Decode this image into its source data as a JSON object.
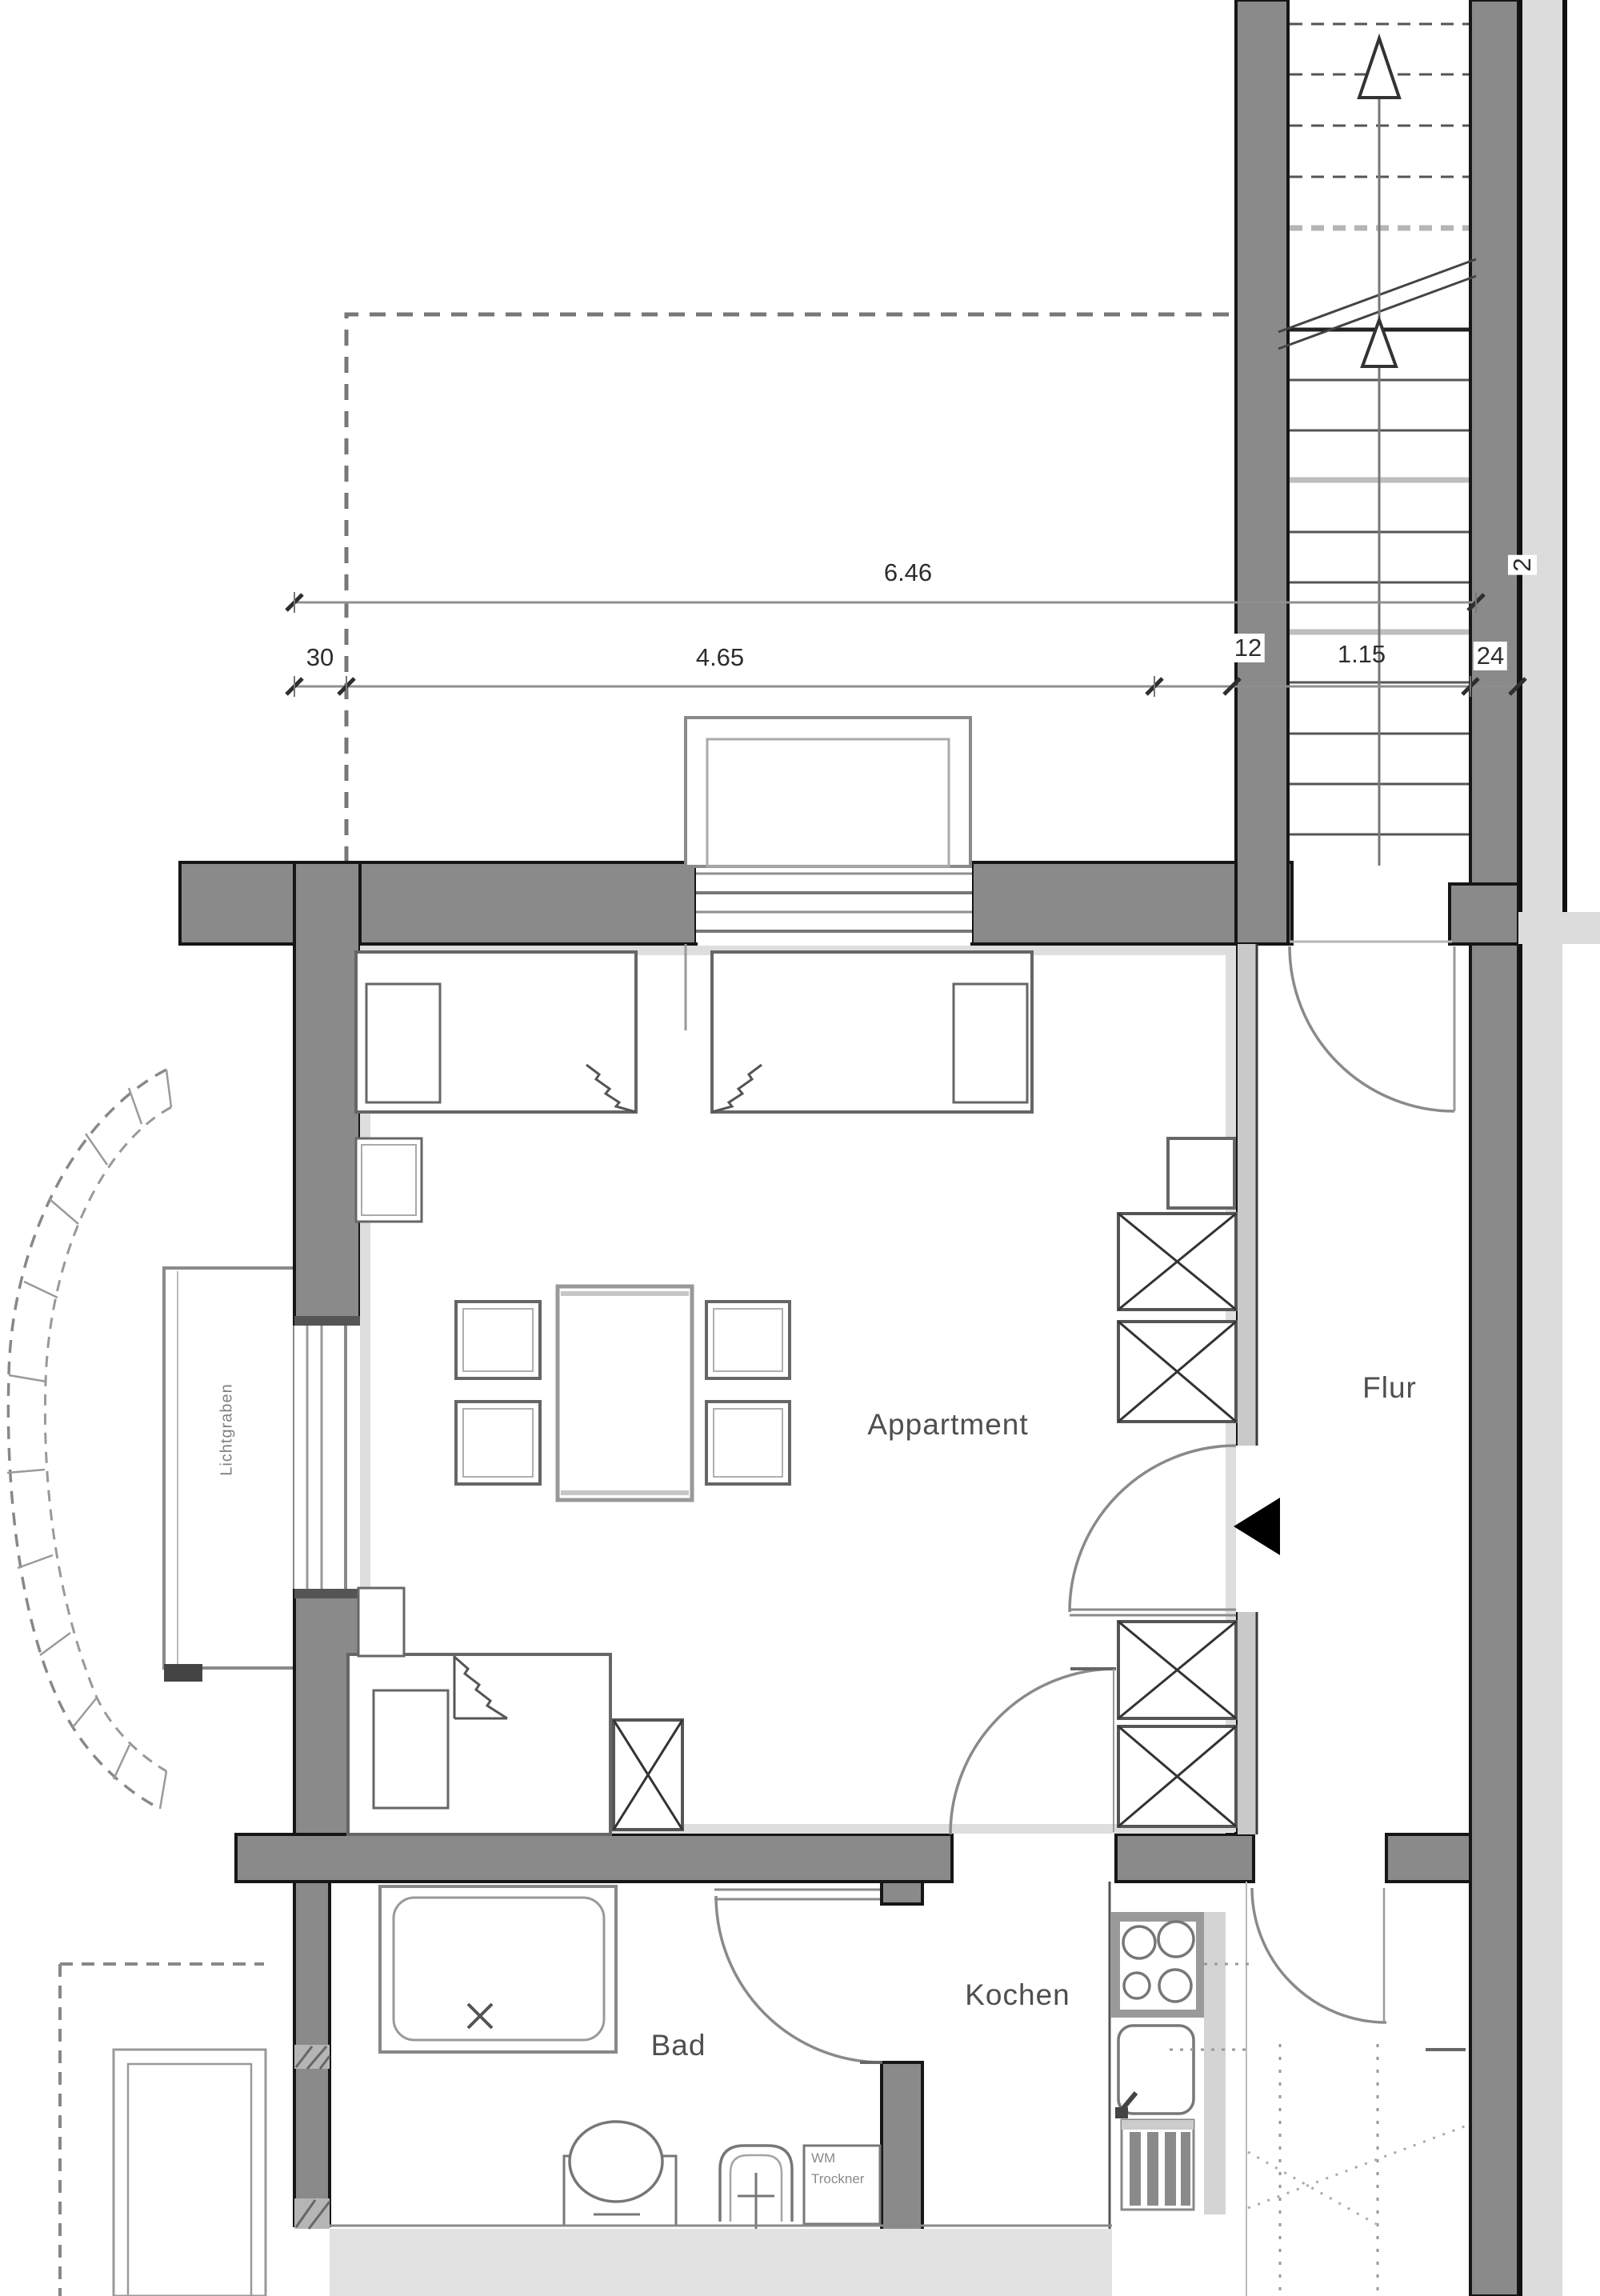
{
  "plan_title": "Appartment Grundriss",
  "rooms": {
    "apartment": "Appartment",
    "hallway": "Flur",
    "bathroom": "Bad",
    "kitchen": "Kochen",
    "lightwell": "Lichtgraben"
  },
  "fixtures": {
    "washer_label": "WM",
    "dryer_label": "Trockner"
  },
  "dimensions": {
    "total_width": "6.46",
    "room_width": "4.65",
    "left_wall": "30",
    "partition": "12",
    "stair_width": "1.15",
    "right_wall": "24",
    "finish": "2"
  },
  "colors": {
    "wall_fill": "#8a8a8a",
    "wall_edge": "#161616",
    "light_strip": "#dcdcdc",
    "line_gray": "#8f8f8f"
  }
}
